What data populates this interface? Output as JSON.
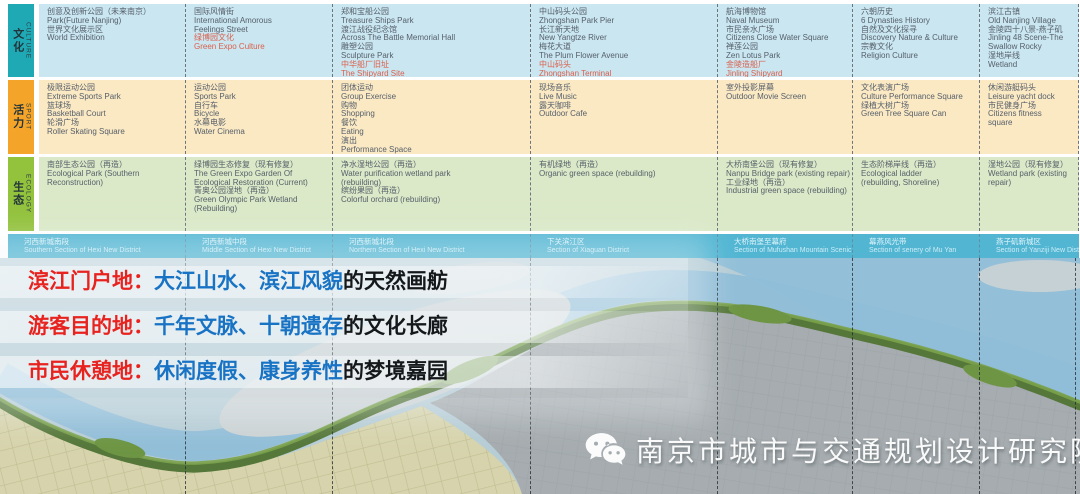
{
  "table": {
    "rows": [
      {
        "id": "culture",
        "zh": "文化",
        "en": "CULTURE",
        "header_bg": "#1fa9b5",
        "row_bg": "#c9e6f1",
        "cells": [
          {
            "lines": [
              {
                "t": "创意及创新公园（未来南京）"
              },
              {
                "t": "Park(Future Nanjing)"
              },
              {
                "t": "世界文化展示区"
              },
              {
                "t": "World Exhibition"
              }
            ]
          },
          {
            "lines": [
              {
                "t": "国际风情街"
              },
              {
                "t": "International Amorous"
              },
              {
                "t": "Feelings Street"
              },
              {
                "t": "绿博园文化",
                "red": true
              },
              {
                "t": "Green Expo Culture",
                "red": true
              }
            ]
          },
          {
            "lines": [
              {
                "t": "郑和宝船公园"
              },
              {
                "t": "Treasure Ships Park"
              },
              {
                "t": "渡江战役纪念馆"
              },
              {
                "t": "Across The Battle Memorial Hall"
              },
              {
                "t": "雕塑公园"
              },
              {
                "t": "Sculpture Park"
              },
              {
                "t": "中华船厂旧址",
                "red": true
              },
              {
                "t": "The Shipyard Site",
                "red": true
              }
            ]
          },
          {
            "lines": [
              {
                "t": "中山码头公园"
              },
              {
                "t": "Zhongshan Park Pier"
              },
              {
                "t": "长江新天地"
              },
              {
                "t": "New Yangtze River"
              },
              {
                "t": "梅花大道"
              },
              {
                "t": "The Plum Flower Avenue"
              },
              {
                "t": "中山码头",
                "red": true
              },
              {
                "t": "Zhongshan Terminal",
                "red": true
              }
            ]
          },
          {
            "lines": [
              {
                "t": "航海博物馆"
              },
              {
                "t": "Naval Museum"
              },
              {
                "t": "市民亲水广场"
              },
              {
                "t": "Citizens Close Water Square"
              },
              {
                "t": "禅莲公园"
              },
              {
                "t": "Zen Lotus Park"
              },
              {
                "t": "金陵造船厂",
                "red": true
              },
              {
                "t": "Jinling Shipyard",
                "red": true
              }
            ]
          },
          {
            "lines": [
              {
                "t": "六朝历史"
              },
              {
                "t": "6 Dynasties History"
              },
              {
                "t": "自然及文化探寻"
              },
              {
                "t": "Discovery Nature & Culture"
              },
              {
                "t": "宗教文化"
              },
              {
                "t": "Religion Culture"
              }
            ]
          },
          {
            "lines": [
              {
                "t": "滨江古镇"
              },
              {
                "t": "Old Nanjing Village"
              },
              {
                "t": "金陵四十八景-燕子矶"
              },
              {
                "t": "Jinling 48 Scene-The"
              },
              {
                "t": "Swallow Rocky"
              },
              {
                "t": "湿地岸线"
              },
              {
                "t": "Wetland"
              }
            ]
          }
        ]
      },
      {
        "id": "sport",
        "zh": "活力",
        "en": "SPORT",
        "header_bg": "#f4a428",
        "row_bg": "#fbe9c4",
        "cells": [
          {
            "lines": [
              {
                "t": "极限运动公园"
              },
              {
                "t": "Extreme Sports Park"
              },
              {
                "t": "篮球场"
              },
              {
                "t": "Basketball Court"
              },
              {
                "t": "轮滑广场"
              },
              {
                "t": "Roller Skating Square"
              }
            ]
          },
          {
            "lines": [
              {
                "t": "运动公园"
              },
              {
                "t": "Sports Park"
              },
              {
                "t": "自行车"
              },
              {
                "t": "Bicycle"
              },
              {
                "t": "水幕电影"
              },
              {
                "t": "Water Cinema"
              }
            ]
          },
          {
            "lines": [
              {
                "t": "团体运动"
              },
              {
                "t": "Group Exercise"
              },
              {
                "t": "购物"
              },
              {
                "t": "Shopping"
              },
              {
                "t": "餐饮"
              },
              {
                "t": "Eating"
              },
              {
                "t": "演出"
              },
              {
                "t": "Performance Space"
              }
            ]
          },
          {
            "lines": [
              {
                "t": "现场音乐"
              },
              {
                "t": "Live Music"
              },
              {
                "t": "露天咖啡"
              },
              {
                "t": "Outdoor Cafe"
              }
            ]
          },
          {
            "lines": [
              {
                "t": "室外投影屏幕"
              },
              {
                "t": "Outdoor Movie Screen"
              }
            ]
          },
          {
            "lines": [
              {
                "t": "文化表演广场"
              },
              {
                "t": "Culture Performance Square"
              },
              {
                "t": "绿植大树广场"
              },
              {
                "t": "Green Tree Square Can"
              }
            ]
          },
          {
            "lines": [
              {
                "t": "休闲游艇码头"
              },
              {
                "t": "Leisure yacht dock"
              },
              {
                "t": "市民健身广场"
              },
              {
                "t": "Citizens fitness"
              },
              {
                "t": "square"
              }
            ]
          }
        ]
      },
      {
        "id": "ecology",
        "zh": "生态",
        "en": "ECOLOGY",
        "header_bg": "#93c23d",
        "row_bg": "#dbe9c8",
        "cells": [
          {
            "lines": [
              {
                "t": "南部生态公园（再造）"
              },
              {
                "t": "Ecological Park (Southern"
              },
              {
                "t": "Reconstruction)"
              }
            ]
          },
          {
            "lines": [
              {
                "t": "绿博园生态修复（现有修复）"
              },
              {
                "t": "The Green Expo Garden Of"
              },
              {
                "t": "Ecological Restoration (Current)"
              },
              {
                "t": "青奥公园湿地（再造）"
              },
              {
                "t": "Green Olympic Park Wetland"
              },
              {
                "t": "(Rebuilding)"
              }
            ]
          },
          {
            "lines": [
              {
                "t": "净水湿地公园（再造）"
              },
              {
                "t": "Water purification wetland park"
              },
              {
                "t": "(rebuilding)"
              },
              {
                "t": "缤纷果园（再造）"
              },
              {
                "t": "Colorful orchard (rebuilding)"
              }
            ]
          },
          {
            "lines": [
              {
                "t": "有机绿地（再造）"
              },
              {
                "t": "Organic green space (rebuilding)"
              }
            ]
          },
          {
            "lines": [
              {
                "t": "大桥南堡公园（现有修复）"
              },
              {
                "t": "Nanpu Bridge park (existing repair)"
              },
              {
                "t": "工业绿地（再造）"
              },
              {
                "t": "Industrial green space (rebuilding)"
              }
            ]
          },
          {
            "lines": [
              {
                "t": "生态阶梯岸线（再造）"
              },
              {
                "t": "Ecological ladder"
              },
              {
                "t": "(rebuilding, Shoreline)"
              }
            ]
          },
          {
            "lines": [
              {
                "t": "湿地公园（现有修复）"
              },
              {
                "t": "Wetland park (existing"
              },
              {
                "t": "repair)"
              }
            ]
          }
        ]
      }
    ],
    "sections": [
      {
        "zh": "河西新城南段",
        "en": "Southern Section of Hexi New District"
      },
      {
        "zh": "河西新城中段",
        "en": "Middle Section of Hexi New District"
      },
      {
        "zh": "河西新城北段",
        "en": "Northern Section of Hexi New District"
      },
      {
        "zh": "下关滨江区",
        "en": "Section of Xiaguan District"
      },
      {
        "zh": "大桥南堡至幕府",
        "en": "Section of Mufushan Mountain Scenic Area"
      },
      {
        "zh": "幕燕风光带",
        "en": "Section of senery of Mu Yan"
      },
      {
        "zh": "燕子矶新城区",
        "en": "Section of Yanziji New District"
      }
    ]
  },
  "slogans": [
    {
      "label": "滨江门户地：",
      "highlight": "大江山水、滨江风貌",
      "tail": "的天然画舫"
    },
    {
      "label": "游客目的地：",
      "highlight": "千年文脉、十朝遗存",
      "tail": "的文化长廊"
    },
    {
      "label": "市民休憩地：",
      "highlight": "休闲度假、康身养性",
      "tail": "的梦境嘉园"
    }
  ],
  "watermark": {
    "icon": "wechat-icon",
    "text": "南京市城市与交通规划设计研究院"
  },
  "colors": {
    "table-red": "#db604c",
    "section-bg": "#52b6d3",
    "slogan-red": "#e8231f",
    "slogan-blue": "#1873c4",
    "map-water": "#8fbdd8",
    "map-green": "#55773a",
    "map-urban": "#a6acaf",
    "map-planned": "#d7d4ad"
  }
}
